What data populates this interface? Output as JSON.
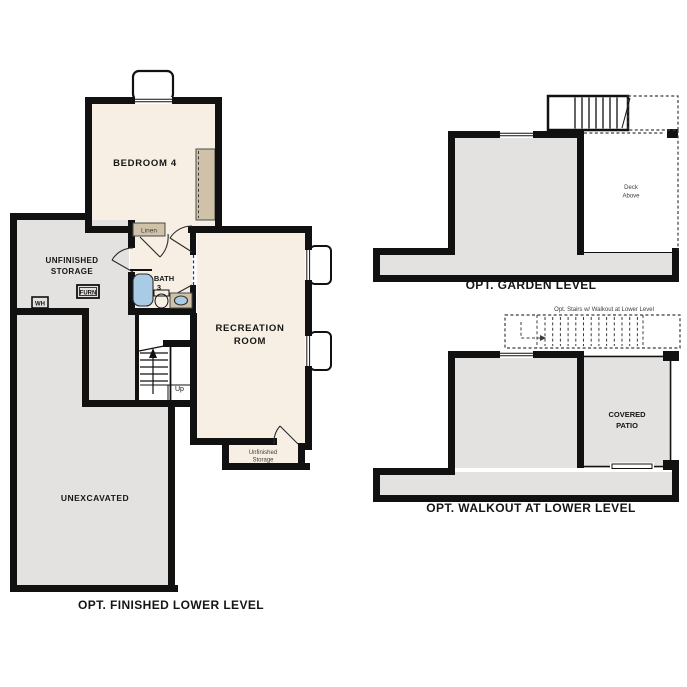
{
  "colors": {
    "wall": "#111111",
    "room": "#f7efe3",
    "garea": "#e3e2e0",
    "tan": "#cfc2a8",
    "blue": "#aacbe6",
    "bg": "#ffffff",
    "text": "#151515",
    "muted": "#3d3d3d"
  },
  "finished_lower_plan": {
    "caption": "OPT. FINISHED LOWER LEVEL",
    "labels": {
      "bedroom4": "BEDROOM 4",
      "unfinished_storage": [
        "UNFINISHED",
        "STORAGE"
      ],
      "furnace": "FURN",
      "water_heater": "WH",
      "linen": "Linen",
      "bath3": [
        "BATH",
        "3"
      ],
      "recreation_room": [
        "RECREATION",
        "ROOM"
      ],
      "stairs_up": "Up",
      "unfinished_storage_small": [
        "Unfinished",
        "Storage"
      ],
      "unexcavated": "UNEXCAVATED"
    }
  },
  "garden_level_plan": {
    "caption": "OPT. GARDEN LEVEL",
    "labels": {
      "deck_above": [
        "Deck",
        "Above"
      ]
    }
  },
  "walkout_plan": {
    "caption": "OPT. WALKOUT AT LOWER LEVEL",
    "labels": {
      "covered_patio": [
        "COVERED",
        "PATIO"
      ],
      "stairs_note": "Opt. Stairs w/ Walkout at Lower Level"
    }
  }
}
